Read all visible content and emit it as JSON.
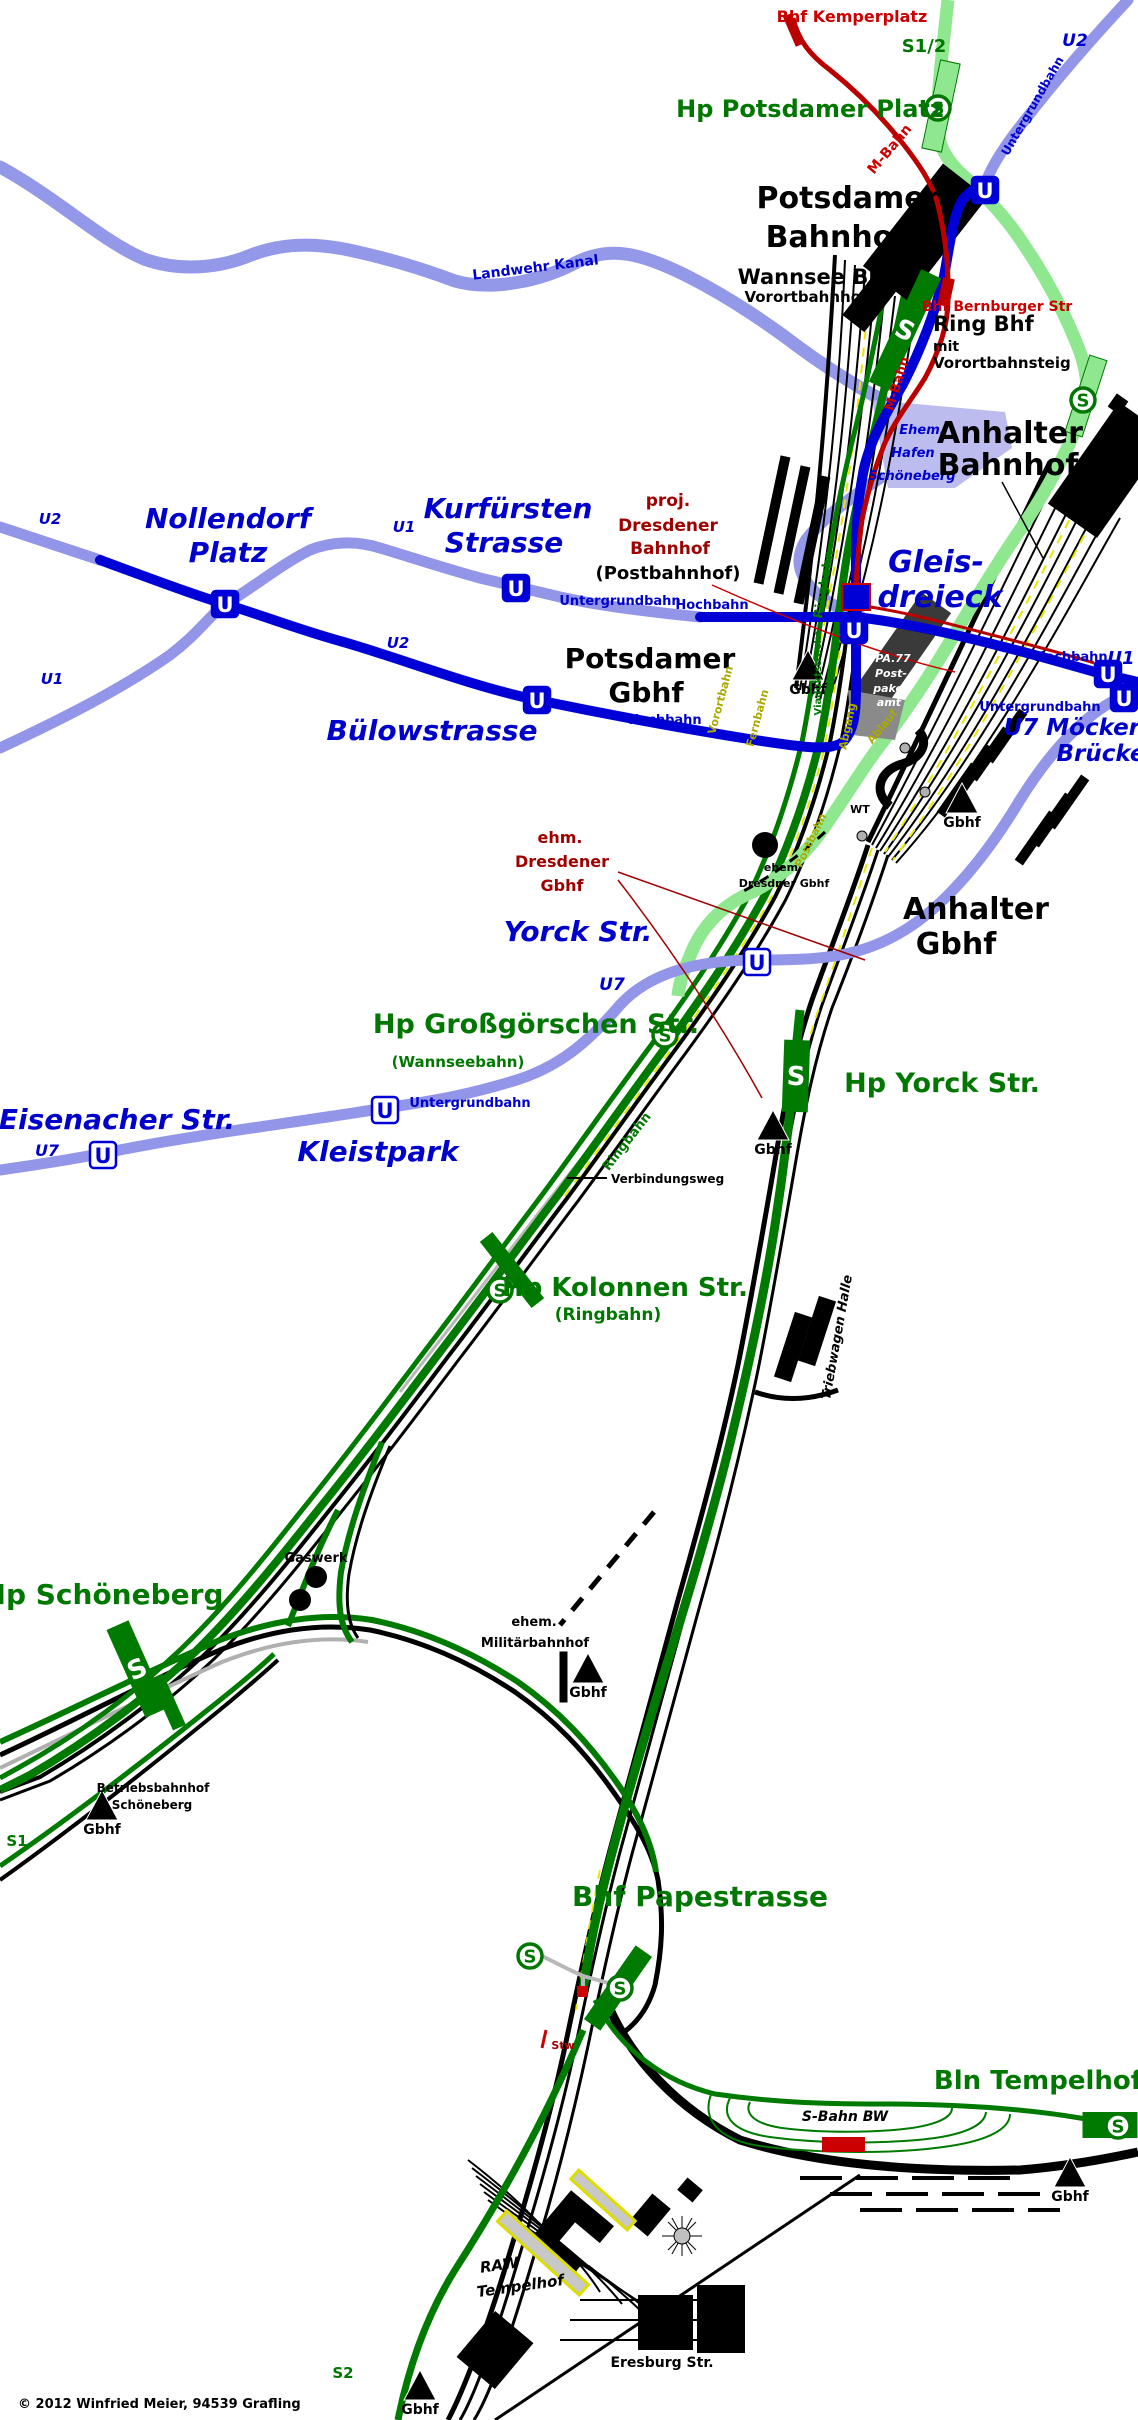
{
  "copyright": "© 2012  Winfried Meier, 94539 Grafling",
  "colors": {
    "black": "#000000",
    "green": "#007700",
    "blue": "#0000CC",
    "red": "#CC0000",
    "darkred": "#A00000",
    "olive": "#AAAA00",
    "white": "#FFFFFF",
    "s_line_light": "#8FE88F",
    "s_line_dark": "#007A00",
    "u_line_light": "#9295E8",
    "u_line_dark": "#0000D6",
    "m_bahn": "#BB0000",
    "kanal": "#9398E8",
    "gray": "#B8B8B8"
  },
  "symbols": {
    "u": "U",
    "s": "S",
    "gbhf_label": "Gbhf"
  },
  "labels": [
    {
      "n": "bhf-kemperplatz",
      "t": "Bhf Kemperplatz",
      "x": 852,
      "y": 22,
      "s": 16,
      "c": "red"
    },
    {
      "n": "s12",
      "t": "S1/2",
      "x": 924,
      "y": 52,
      "s": 18,
      "c": "green"
    },
    {
      "n": "u2-top",
      "t": "U2",
      "x": 1075,
      "y": 46,
      "s": 17,
      "c": "blue",
      "i": 1
    },
    {
      "n": "untergrundbahn-top",
      "t": "Untergrundbahn",
      "x": 1036,
      "y": 108,
      "s": 12,
      "c": "blue",
      "r": -60
    },
    {
      "n": "hp-potsdamer-platz",
      "t": "Hp Potsdamer Platz",
      "x": 810,
      "y": 117,
      "s": 24,
      "c": "green"
    },
    {
      "n": "m-bahn-1",
      "t": "M-Bahn",
      "x": 893,
      "y": 152,
      "s": 14,
      "c": "red",
      "r": -50
    },
    {
      "n": "potsdamer-bahnhof-1",
      "t": "Potsdamer",
      "x": 848,
      "y": 208,
      "s": 30,
      "c": "black"
    },
    {
      "n": "potsdamer-bahnhof-2",
      "t": "Bahnhof",
      "x": 836,
      "y": 247,
      "s": 30,
      "c": "black"
    },
    {
      "n": "wannsee-bhf",
      "t": "Wannsee Bhf",
      "x": 815,
      "y": 284,
      "s": 21,
      "c": "black"
    },
    {
      "n": "vorortbahnhof",
      "t": "Vorortbahnhof",
      "x": 806,
      "y": 302,
      "s": 15,
      "c": "black"
    },
    {
      "n": "bhf-bernburger",
      "t": "Bhf Bernburger Str",
      "x": 997,
      "y": 311,
      "s": 14,
      "c": "red"
    },
    {
      "n": "ring-bhf",
      "t": "Ring Bhf",
      "x": 933,
      "y": 331,
      "s": 21,
      "c": "black",
      "a": "start"
    },
    {
      "n": "ring-bhf-mit",
      "t": "mit",
      "x": 933,
      "y": 351,
      "s": 14,
      "c": "black",
      "a": "start"
    },
    {
      "n": "vorortbahnsteig",
      "t": "Vorortbahnsteig",
      "x": 933,
      "y": 368,
      "s": 15,
      "c": "black",
      "a": "start"
    },
    {
      "n": "landwehr-kanal",
      "t": "Landwehr Kanal",
      "x": 536,
      "y": 272,
      "s": 14,
      "c": "blue",
      "r": -7
    },
    {
      "n": "m-bahn-2",
      "t": "M-Bahn",
      "x": 901,
      "y": 385,
      "s": 13,
      "c": "red",
      "r": -73
    },
    {
      "n": "ehem-hafen-1",
      "t": "Ehem.",
      "x": 922,
      "y": 434,
      "s": 13,
      "c": "blue",
      "i": 1
    },
    {
      "n": "ehem-hafen-2",
      "t": "Hafen",
      "x": 913,
      "y": 457,
      "s": 13,
      "c": "blue",
      "i": 1
    },
    {
      "n": "ehem-hafen-3",
      "t": "Schöneberg",
      "x": 912,
      "y": 480,
      "s": 13,
      "c": "blue",
      "i": 1
    },
    {
      "n": "anhalter-bahnhof-1",
      "t": "Anhalter",
      "x": 1010,
      "y": 443,
      "s": 30,
      "c": "black"
    },
    {
      "n": "anhalter-bahnhof-2",
      "t": "Bahnhof",
      "x": 1008,
      "y": 475,
      "s": 30,
      "c": "black"
    },
    {
      "n": "gleisdreieck-1",
      "t": "Gleis-",
      "x": 936,
      "y": 572,
      "s": 30,
      "c": "blue",
      "i": 1
    },
    {
      "n": "gleisdreieck-2",
      "t": "dreieck",
      "x": 940,
      "y": 607,
      "s": 30,
      "c": "blue",
      "i": 1
    },
    {
      "n": "u2-left",
      "t": "U2",
      "x": 50,
      "y": 524,
      "s": 15,
      "c": "blue",
      "i": 1
    },
    {
      "n": "u1-left",
      "t": "U1",
      "x": 52,
      "y": 684,
      "s": 15,
      "c": "blue",
      "i": 1
    },
    {
      "n": "nollendorf-1",
      "t": "Nollendorf",
      "x": 228,
      "y": 528,
      "s": 28,
      "c": "blue",
      "i": 1
    },
    {
      "n": "nollendorf-2",
      "t": "Platz",
      "x": 228,
      "y": 562,
      "s": 28,
      "c": "blue",
      "i": 1
    },
    {
      "n": "u1-mid",
      "t": "U1",
      "x": 404,
      "y": 532,
      "s": 15,
      "c": "blue",
      "i": 1
    },
    {
      "n": "u2-mid",
      "t": "U2",
      "x": 398,
      "y": 648,
      "s": 15,
      "c": "blue",
      "i": 1
    },
    {
      "n": "kurfuersten-1",
      "t": "Kurfürsten",
      "x": 508,
      "y": 518,
      "s": 28,
      "c": "blue",
      "i": 1
    },
    {
      "n": "kurfuersten-2",
      "t": "Strasse",
      "x": 504,
      "y": 552,
      "s": 28,
      "c": "blue",
      "i": 1
    },
    {
      "n": "proj-dresdener-1",
      "t": "proj.",
      "x": 668,
      "y": 506,
      "s": 17,
      "c": "darkred"
    },
    {
      "n": "proj-dresdener-2",
      "t": "Dresdener",
      "x": 668,
      "y": 531,
      "s": 17,
      "c": "darkred"
    },
    {
      "n": "proj-dresdener-3",
      "t": "Bahnhof",
      "x": 670,
      "y": 554,
      "s": 17,
      "c": "darkred"
    },
    {
      "n": "postbahnhof",
      "t": "(Postbahnhof)",
      "x": 668,
      "y": 579,
      "s": 18,
      "c": "black"
    },
    {
      "n": "untergrundbahn-gd",
      "t": "Untergrundbahn",
      "x": 620,
      "y": 605,
      "s": 13,
      "c": "blue"
    },
    {
      "n": "hochbahn-gd",
      "t": "Hochbahn",
      "x": 712,
      "y": 609,
      "s": 13,
      "c": "blue"
    },
    {
      "n": "potsdamer-gbhf-1",
      "t": "Potsdamer",
      "x": 650,
      "y": 668,
      "s": 28,
      "c": "black"
    },
    {
      "n": "potsdamer-gbhf-2",
      "t": "Gbhf",
      "x": 646,
      "y": 702,
      "s": 28,
      "c": "black"
    },
    {
      "n": "hochbahn-bue",
      "t": "Hochbahn",
      "x": 665,
      "y": 724,
      "s": 13,
      "c": "blue"
    },
    {
      "n": "buelowstrasse",
      "t": "Bülowstrasse",
      "x": 432,
      "y": 740,
      "s": 28,
      "c": "blue",
      "i": 1
    },
    {
      "n": "hochbahn-moe",
      "t": "Hochbahn",
      "x": 1071,
      "y": 661,
      "s": 13,
      "c": "blue"
    },
    {
      "n": "u1-moe",
      "t": "U1",
      "x": 1121,
      "y": 664,
      "s": 18,
      "c": "blue",
      "i": 1
    },
    {
      "n": "untergrundbahn-moe",
      "t": "Untergrundbahn",
      "x": 1040,
      "y": 711,
      "s": 13,
      "c": "blue"
    },
    {
      "n": "u7-moeckern",
      "t": "U7 Möckern",
      "x": 1080,
      "y": 735,
      "s": 23,
      "c": "blue",
      "i": 1
    },
    {
      "n": "bruecke",
      "t": "Brücke",
      "x": 1101,
      "y": 761,
      "s": 23,
      "c": "blue",
      "i": 1
    },
    {
      "n": "ehm-dresdener-1",
      "t": "ehm.",
      "x": 560,
      "y": 843,
      "s": 16,
      "c": "darkred"
    },
    {
      "n": "ehm-dresdener-2",
      "t": "Dresdener",
      "x": 562,
      "y": 867,
      "s": 16,
      "c": "darkred"
    },
    {
      "n": "ehm-dresdener-3",
      "t": "Gbhf",
      "x": 562,
      "y": 891,
      "s": 16,
      "c": "darkred"
    },
    {
      "n": "yorck-str",
      "t": "Yorck Str.",
      "x": 578,
      "y": 941,
      "s": 28,
      "c": "blue",
      "i": 1
    },
    {
      "n": "u7-yorck",
      "t": "U7",
      "x": 612,
      "y": 990,
      "s": 17,
      "c": "blue",
      "i": 1
    },
    {
      "n": "hp-grossgoerschen",
      "t": "Hp Großgörschen Str.",
      "x": 536,
      "y": 1033,
      "s": 27,
      "c": "green"
    },
    {
      "n": "wannseebahn",
      "t": "(Wannseebahn)",
      "x": 458,
      "y": 1067,
      "s": 15,
      "c": "green"
    },
    {
      "n": "hp-yorck-str",
      "t": "Hp Yorck Str.",
      "x": 942,
      "y": 1092,
      "s": 27,
      "c": "green"
    },
    {
      "n": "anhalter-gbhf-1",
      "t": "Anhalter",
      "x": 976,
      "y": 919,
      "s": 30,
      "c": "black"
    },
    {
      "n": "anhalter-gbhf-2",
      "t": "Gbhf",
      "x": 956,
      "y": 954,
      "s": 30,
      "c": "black"
    },
    {
      "n": "ehem-dresdner-site-1",
      "t": "ehem",
      "x": 781,
      "y": 871,
      "s": 11,
      "c": "black"
    },
    {
      "n": "ehem-dresdner-site-2",
      "t": "Dresdner Gbhf",
      "x": 784,
      "y": 887,
      "s": 11,
      "c": "black"
    },
    {
      "n": "eisenacher",
      "t": "Eisenacher Str.",
      "x": 117,
      "y": 1129,
      "s": 28,
      "c": "blue",
      "i": 1
    },
    {
      "n": "u7-eis",
      "t": "U7",
      "x": 47,
      "y": 1156,
      "s": 16,
      "c": "blue",
      "i": 1
    },
    {
      "n": "kleistpark",
      "t": "Kleistpark",
      "x": 378,
      "y": 1161,
      "s": 28,
      "c": "blue",
      "i": 1
    },
    {
      "n": "untergrundbahn-klp",
      "t": "Untergrundbahn",
      "x": 470,
      "y": 1107,
      "s": 13,
      "c": "blue"
    },
    {
      "n": "ringbahn-1",
      "t": "Ringbahn",
      "x": 828,
      "y": 585,
      "s": 13,
      "c": "green",
      "r": -80
    },
    {
      "n": "viaduktstrecke",
      "t": "Viaduktstrecke",
      "x": 821,
      "y": 673,
      "s": 10,
      "c": "green",
      "r": -90
    },
    {
      "n": "ringbahn-2",
      "t": "Ringbahn",
      "x": 630,
      "y": 1144,
      "s": 13,
      "c": "green",
      "r": -52
    },
    {
      "n": "vorortbahn-y",
      "t": "Vorortbahn",
      "x": 724,
      "y": 701,
      "s": 11,
      "c": "olive",
      "r": -75
    },
    {
      "n": "fernbahn-y",
      "t": "Fernbahn",
      "x": 761,
      "y": 719,
      "s": 11,
      "c": "olive",
      "r": -75
    },
    {
      "n": "abgang",
      "t": "Abgang",
      "x": 851,
      "y": 727,
      "s": 11,
      "c": "olive",
      "r": -78
    },
    {
      "n": "ablauf",
      "t": "Ablauf",
      "x": 885,
      "y": 729,
      "s": 11,
      "c": "olive",
      "r": -50
    },
    {
      "n": "postbahn",
      "t": "Postbahn",
      "x": 814,
      "y": 842,
      "s": 11,
      "c": "olive",
      "r": -64
    },
    {
      "n": "wt",
      "t": "WT",
      "x": 860,
      "y": 813,
      "s": 11,
      "c": "black"
    },
    {
      "n": "pa77-1",
      "t": "PA.77",
      "x": 893,
      "y": 662,
      "s": 11,
      "c": "white",
      "i": 1
    },
    {
      "n": "pa77-2",
      "t": "Post-",
      "x": 891,
      "y": 677,
      "s": 11,
      "c": "white",
      "i": 1
    },
    {
      "n": "pa77-3",
      "t": "paket-",
      "x": 893,
      "y": 692,
      "s": 11,
      "c": "white",
      "i": 1
    },
    {
      "n": "pa77-4",
      "t": "amt",
      "x": 889,
      "y": 706,
      "s": 11,
      "c": "white",
      "i": 1
    },
    {
      "n": "verbindungsweg",
      "t": "Verbindungsweg",
      "x": 611,
      "y": 1183,
      "s": 12,
      "c": "black",
      "a": "start"
    },
    {
      "n": "hp-kolonnen",
      "t": "Hp Kolonnen Str.",
      "x": 625,
      "y": 1296,
      "s": 26,
      "c": "green"
    },
    {
      "n": "ringbahn-kol",
      "t": "(Ringbahn)",
      "x": 608,
      "y": 1320,
      "s": 17,
      "c": "green"
    },
    {
      "n": "triebwagen-halle",
      "t": "Triebwagen Halle",
      "x": 841,
      "y": 1338,
      "s": 13,
      "c": "black",
      "i": 1,
      "r": -80
    },
    {
      "n": "gaswerk",
      "t": "Gaswerk",
      "x": 316,
      "y": 1562,
      "s": 13,
      "c": "black"
    },
    {
      "n": "ehem-mil-1",
      "t": "ehem.",
      "x": 534,
      "y": 1626,
      "s": 13,
      "c": "black"
    },
    {
      "n": "ehem-mil-2",
      "t": "Militärbahnhof",
      "x": 535,
      "y": 1647,
      "s": 13,
      "c": "black"
    },
    {
      "n": "hp-schoeneberg",
      "t": "Hp Schöneberg",
      "x": 103,
      "y": 1604,
      "s": 28,
      "c": "green"
    },
    {
      "n": "betriebsbahnhof-1",
      "t": "Betriebsbahnhof",
      "x": 153,
      "y": 1792,
      "s": 12,
      "c": "black"
    },
    {
      "n": "betriebsbahnhof-2",
      "t": "Schöneberg",
      "x": 152,
      "y": 1809,
      "s": 12,
      "c": "black"
    },
    {
      "n": "s1",
      "t": "S1",
      "x": 17,
      "y": 1846,
      "s": 15,
      "c": "green"
    },
    {
      "n": "bhf-papestrasse",
      "t": "Bhf Papestrasse",
      "x": 700,
      "y": 1906,
      "s": 28,
      "c": "green"
    },
    {
      "n": "stw",
      "t": "Stw",
      "x": 563,
      "y": 2049,
      "s": 11,
      "c": "darkred"
    },
    {
      "n": "bln-tempelhof",
      "t": "Bln Tempelhof",
      "x": 1038,
      "y": 2089,
      "s": 26,
      "c": "green"
    },
    {
      "n": "s-bahn-bw",
      "t": "S-Bahn BW",
      "x": 845,
      "y": 2121,
      "s": 14,
      "c": "black",
      "i": 1
    },
    {
      "n": "raw-1",
      "t": "RAW",
      "x": 500,
      "y": 2270,
      "s": 15,
      "c": "black",
      "i": 1,
      "r": -8
    },
    {
      "n": "raw-2",
      "t": "Tempelhof",
      "x": 521,
      "y": 2291,
      "s": 15,
      "c": "black",
      "i": 1,
      "r": -8
    },
    {
      "n": "eresburg",
      "t": "Eresburg Str.",
      "x": 662,
      "y": 2367,
      "s": 14,
      "c": "black"
    },
    {
      "n": "s2",
      "t": "S2",
      "x": 343,
      "y": 2378,
      "s": 15,
      "c": "green"
    },
    {
      "n": "copyright",
      "t": "© 2012  Winfried Meier, 94539 Grafling",
      "x": 18,
      "y": 2408,
      "s": 13,
      "c": "black",
      "a": "start"
    }
  ],
  "stations": {
    "u": [
      {
        "n": "u-potsdamer-platz",
        "x": 985,
        "y": 190
      },
      {
        "n": "u-nollendorfplatz",
        "x": 225,
        "y": 604
      },
      {
        "n": "u-kurfuerstenstrasse",
        "x": 516,
        "y": 588
      },
      {
        "n": "u-buelowstrasse",
        "x": 537,
        "y": 700
      },
      {
        "n": "u-gleisdreieck",
        "x": 854,
        "y": 630
      },
      {
        "n": "u-moeckernbruecke-u1",
        "x": 1108,
        "y": 674
      },
      {
        "n": "u-moeckernbruecke-u7",
        "x": 1124,
        "y": 698
      },
      {
        "n": "u-eisenacher-strasse",
        "x": 103,
        "y": 1155,
        "l": 1
      },
      {
        "n": "u-kleistpark",
        "x": 385,
        "y": 1110,
        "l": 1
      },
      {
        "n": "u-yorckstrasse",
        "x": 757,
        "y": 962,
        "l": 1
      }
    ],
    "s_circles": [
      {
        "n": "s-potsdamer-platz",
        "x": 938,
        "y": 108
      },
      {
        "n": "s-anhalter-bahnhof",
        "x": 1083,
        "y": 400
      },
      {
        "n": "s-grossgoerschenstrasse",
        "x": 665,
        "y": 1035
      },
      {
        "n": "s-kolonnenstrasse",
        "x": 500,
        "y": 1290
      },
      {
        "n": "s-papestrasse-ring",
        "x": 530,
        "y": 1956
      },
      {
        "n": "s-papestrasse-vorort",
        "x": 620,
        "y": 1988
      },
      {
        "n": "s-tempelhof",
        "x": 1118,
        "y": 2126
      }
    ],
    "s_platforms": [
      {
        "n": "wannsee-bhf-platform",
        "x": 905,
        "y": 330,
        "r": 25,
        "w": 22,
        "h": 124,
        "L": 1
      },
      {
        "n": "yorck-platform",
        "x": 796,
        "y": 1076,
        "r": 2,
        "w": 26,
        "h": 72,
        "L": 1
      },
      {
        "n": "schoeneberg-platform",
        "x": 137,
        "y": 1669,
        "r": -24,
        "w": 24,
        "h": 96,
        "L": 1
      },
      {
        "n": "schoeneberg-platform-2",
        "x": 168,
        "y": 1702,
        "r": -24,
        "w": 14,
        "h": 56,
        "L": 0
      },
      {
        "n": "papestrasse-platform",
        "x": 618,
        "y": 1988,
        "r": 35,
        "w": 20,
        "h": 90,
        "L": 0
      },
      {
        "n": "kolonnen-platform",
        "x": 512,
        "y": 1270,
        "r": -38,
        "w": 16,
        "h": 84,
        "L": 0
      },
      {
        "n": "potsdamer-platz-platform",
        "x": 941,
        "y": 106,
        "r": 12,
        "w": 20,
        "h": 90,
        "L": 0,
        "light": 1
      },
      {
        "n": "anhalter-platform",
        "x": 1086,
        "y": 396,
        "r": 18,
        "w": 18,
        "h": 80,
        "L": 0,
        "light": 1
      },
      {
        "n": "tempelhof-platform",
        "x": 1110,
        "y": 2125,
        "r": 0,
        "w": 55,
        "h": 26,
        "L": 0
      }
    ]
  },
  "gbhf_markers": [
    {
      "n": "gbhf-potsdamer",
      "x": 808,
      "y": 650
    },
    {
      "n": "gbhf-anhalter",
      "x": 962,
      "y": 783
    },
    {
      "n": "gbhf-yorck",
      "x": 773,
      "y": 1110
    },
    {
      "n": "gbhf-militaer",
      "x": 588,
      "y": 1653
    },
    {
      "n": "gbhf-schoeneberg",
      "x": 102,
      "y": 1790
    },
    {
      "n": "gbhf-tempelhof",
      "x": 1070,
      "y": 2157
    },
    {
      "n": "gbhf-sued",
      "x": 420,
      "y": 2370
    }
  ]
}
